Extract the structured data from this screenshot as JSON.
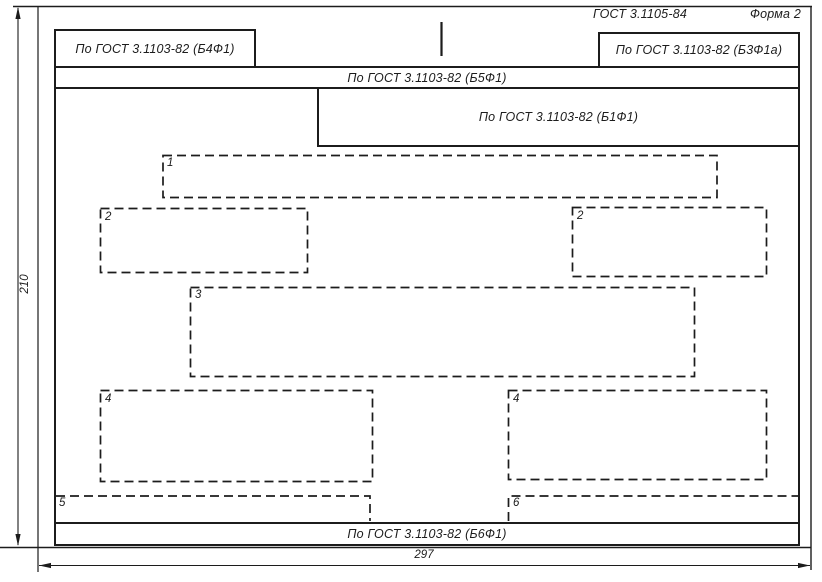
{
  "header": {
    "standard": "ГОСТ 3.1105-84",
    "form": "Форма 2"
  },
  "blocks": {
    "top_left": "По ГОСТ 3.1103-82 (Б4Ф1)",
    "top_right": "По ГОСТ 3.1103-82 (Б3Ф1а)",
    "top_band": "По ГОСТ 3.1103-82 (Б5Ф1)",
    "title_block": "По ГОСТ 3.1103-82 (Б1Ф1)",
    "bottom_band": "По ГОСТ 3.1103-82 (Б6Ф1)"
  },
  "zones": [
    {
      "label": "1"
    },
    {
      "label": "2"
    },
    {
      "label": "2"
    },
    {
      "label": "3"
    },
    {
      "label": "4"
    },
    {
      "label": "4"
    },
    {
      "label": "5"
    },
    {
      "label": "6"
    }
  ],
  "dimensions": {
    "sheet_height_mm": "210",
    "sheet_width_mm": "297"
  },
  "colors": {
    "line": "#1c1c1c",
    "background": "#ffffff"
  }
}
